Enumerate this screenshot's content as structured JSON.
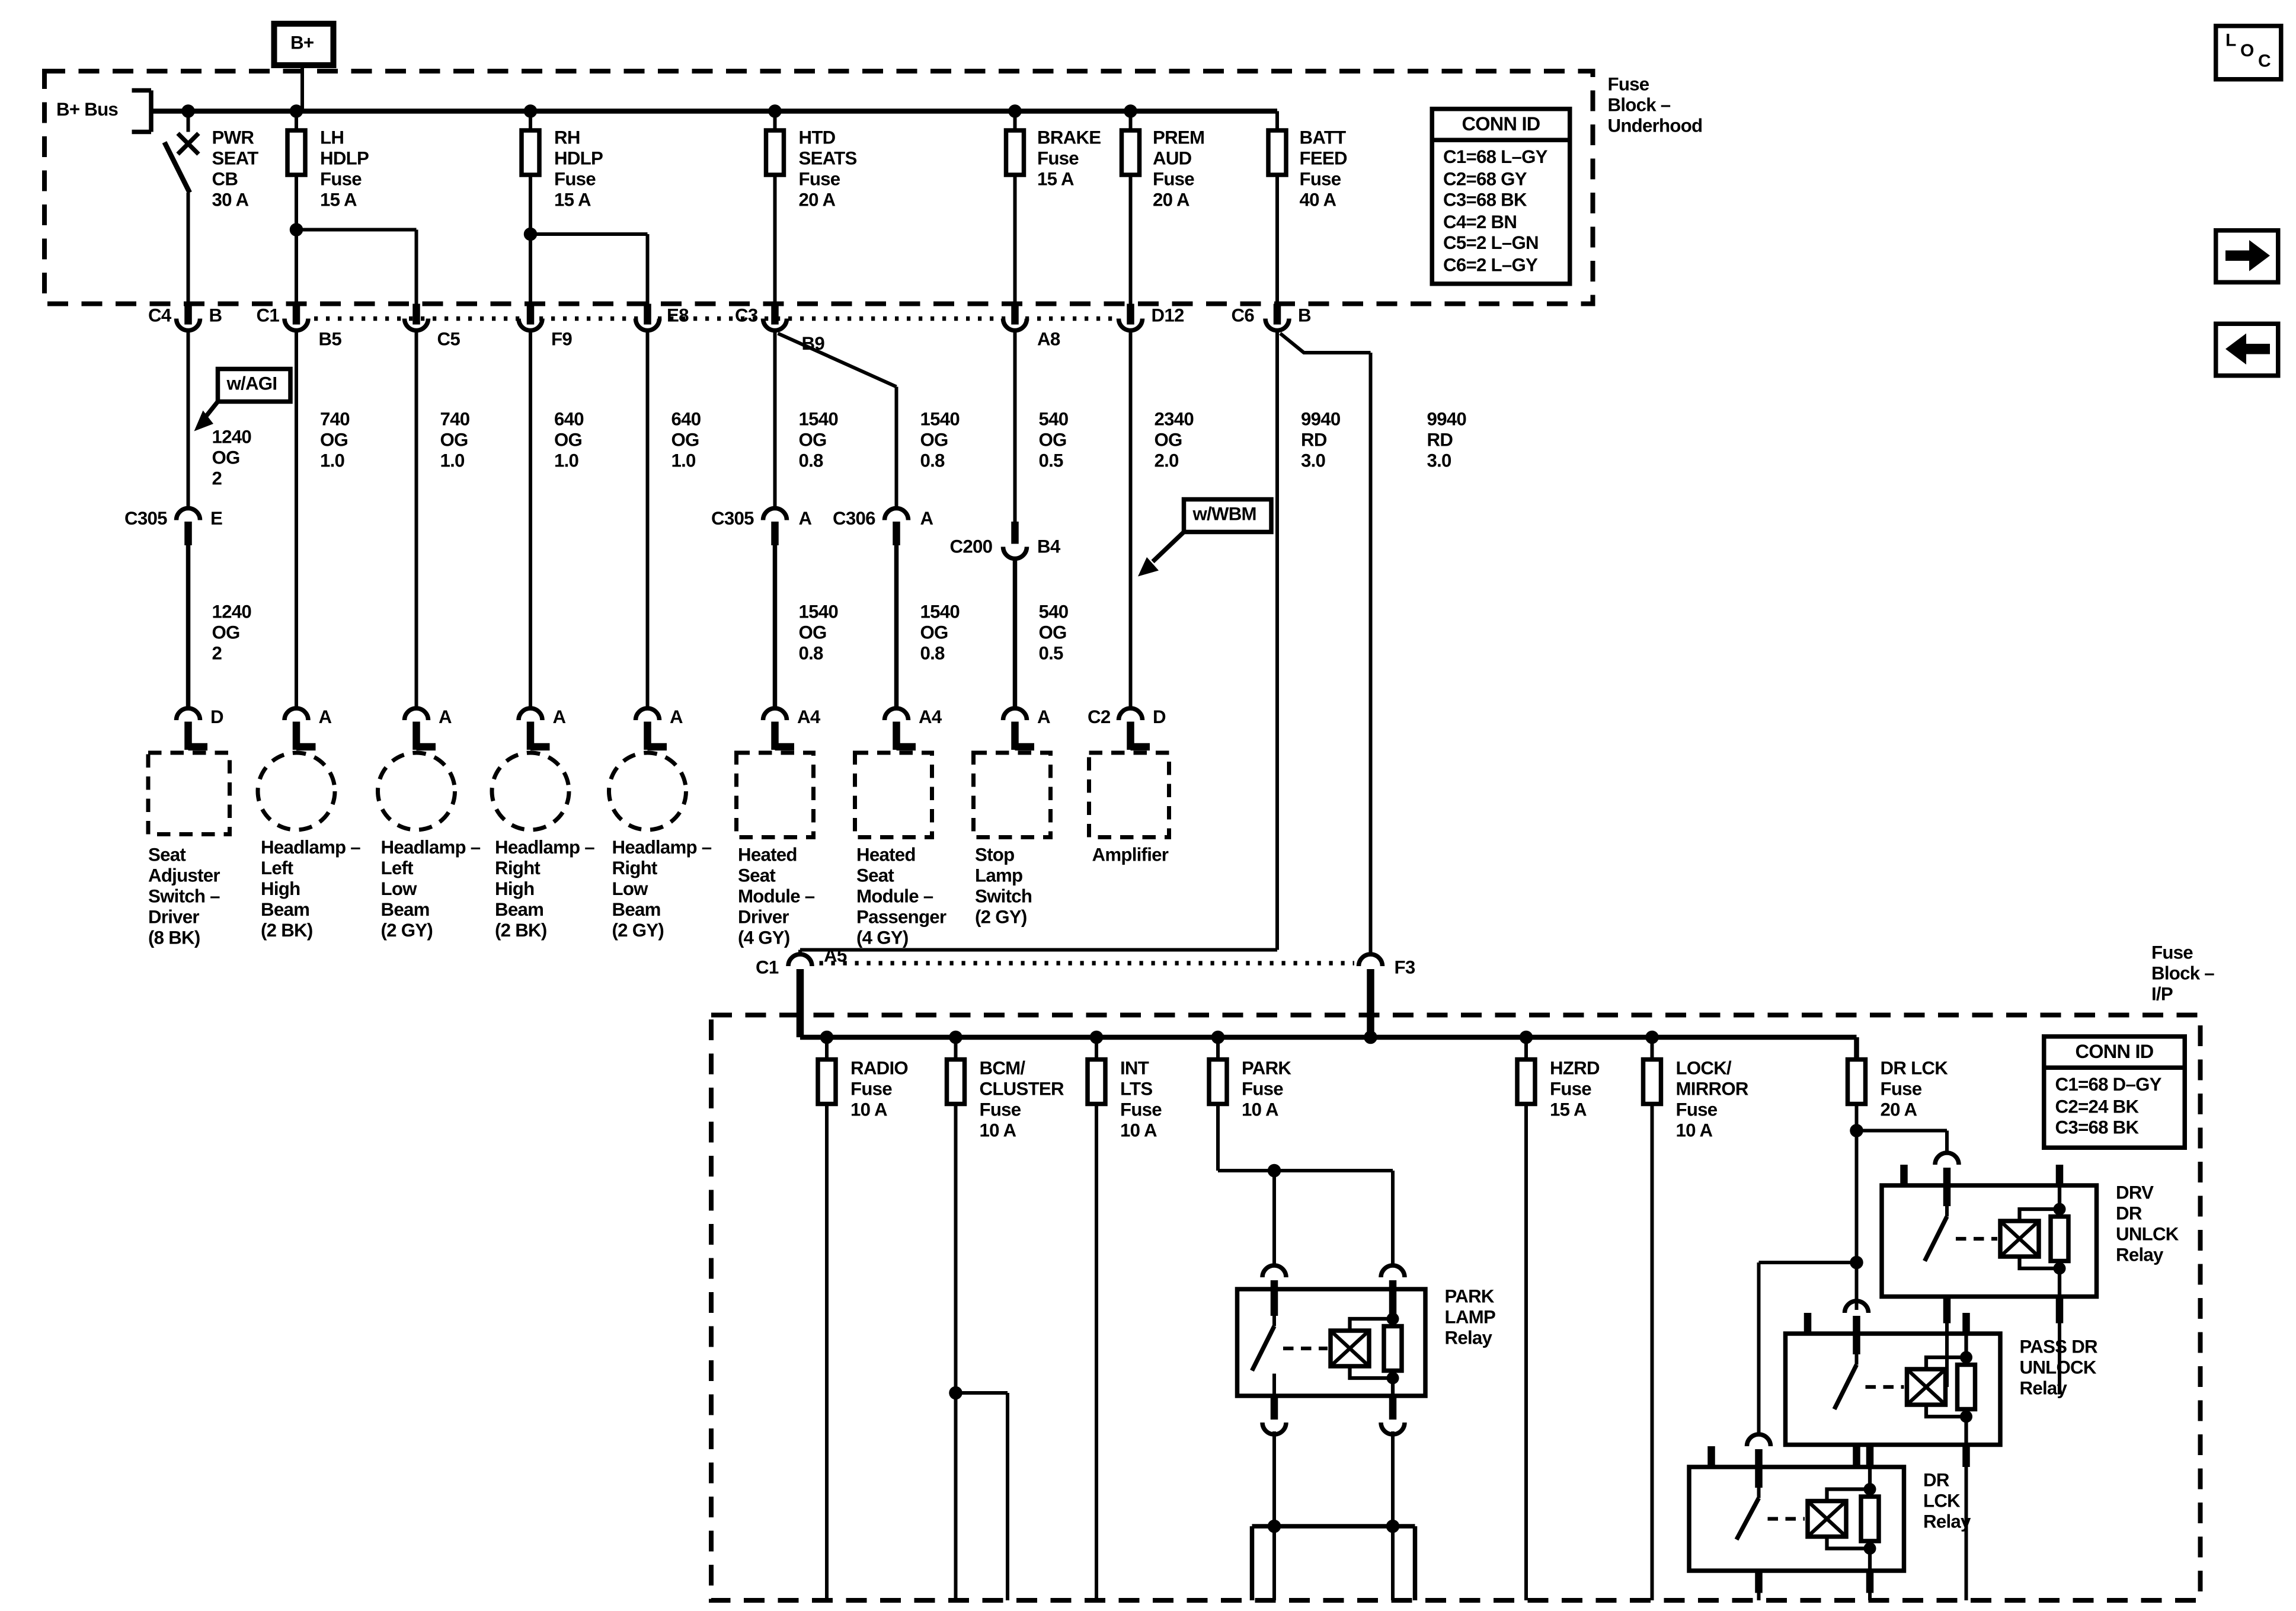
{
  "colors": {
    "ink": "#000000",
    "paper": "#ffffff"
  },
  "nav": {
    "loc": [
      "L",
      "O",
      "C"
    ]
  },
  "underhood": {
    "block_label": "Fuse\nBlock –\nUnderhood",
    "bplus": "B+",
    "bplus_bus": "B+ Bus",
    "conn_id": {
      "title": "CONN ID",
      "rows": "C1=68 L–GY\nC2=68 GY\nC3=68 BK\nC4=2 BN\nC5=2 L–GN\nC6=2 L–GY"
    },
    "fuses": {
      "pwr_seat": "PWR\nSEAT\nCB\n30 A",
      "lh_hdlp": "LH\nHDLP\nFuse\n15 A",
      "rh_hdlp": "RH\nHDLP\nFuse\n15 A",
      "htd_seats": "HTD\nSEATS\nFuse\n20 A",
      "brake": "BRAKE\nFuse\n15 A",
      "prem_aud": "PREM\nAUD\nFuse\n20 A",
      "batt_feed": "BATT\nFEED\nFuse\n40 A"
    }
  },
  "pins": {
    "c4": "C4",
    "c1": "C1",
    "c3": "C3",
    "c6": "C6",
    "b": "B",
    "b5": "B5",
    "c5": "C5",
    "f9": "F9",
    "e8": "E8",
    "b9": "B9",
    "a8": "A8",
    "d12": "D12",
    "a": "A",
    "a4": "A4",
    "d": "D",
    "e": "E",
    "b4": "B4",
    "c2": "C2",
    "c305": "C305",
    "c306": "C306",
    "c200": "C200",
    "a5": "A5",
    "f3": "F3"
  },
  "callouts": {
    "agi": "w/AGI",
    "wbm": "w/WBM"
  },
  "wires": {
    "w1240": "1240\nOG\n2",
    "w740": "740\nOG\n1.0",
    "w640": "640\nOG\n1.0",
    "w1540": "1540\nOG\n0.8",
    "w540": "540\nOG\n0.5",
    "w2340": "2340\nOG\n2.0",
    "w9940": "9940\nRD\n3.0"
  },
  "components": {
    "seat_adjuster": "Seat\nAdjuster\nSwitch –\nDriver\n(8 BK)",
    "headlamp_lh": "Headlamp –\nLeft\nHigh\nBeam\n(2 BK)",
    "headlamp_ll": "Headlamp –\nLeft\nLow\nBeam\n(2 GY)",
    "headlamp_rh": "Headlamp –\nRight\nHigh\nBeam\n(2 BK)",
    "headlamp_rl": "Headlamp –\nRight\nLow\nBeam\n(2 GY)",
    "heated_seat_driver": "Heated\nSeat\nModule –\nDriver\n(4 GY)",
    "heated_seat_passenger": "Heated\nSeat\nModule –\nPassenger\n(4 GY)",
    "stop_lamp": "Stop\nLamp\nSwitch\n(2 GY)",
    "amplifier": "Amplifier"
  },
  "ip": {
    "block_label": "Fuse\nBlock –\nI/P",
    "conn_id": {
      "title": "CONN ID",
      "rows": "C1=68 D–GY\nC2=24 BK\nC3=68 BK"
    },
    "fuses": {
      "radio": "RADIO\nFuse\n10 A",
      "bcm": "BCM/\nCLUSTER\nFuse\n10 A",
      "int_lts": "INT\nLTS\nFuse\n10 A",
      "park": "PARK\nFuse\n10 A",
      "hzrd": "HZRD\nFuse\n15 A",
      "lock_mirror": "LOCK/\nMIRROR\nFuse\n10 A",
      "dr_lck": "DR LCK\nFuse\n20 A"
    },
    "relays": {
      "park_lamp": "PARK\nLAMP\nRelay",
      "drv_unlck": "DRV\nDR\nUNLCK\nRelay",
      "pass_unlock": "PASS DR\nUNLOCK\nRelay",
      "dr_lck": "DR\nLCK\nRelay"
    }
  }
}
